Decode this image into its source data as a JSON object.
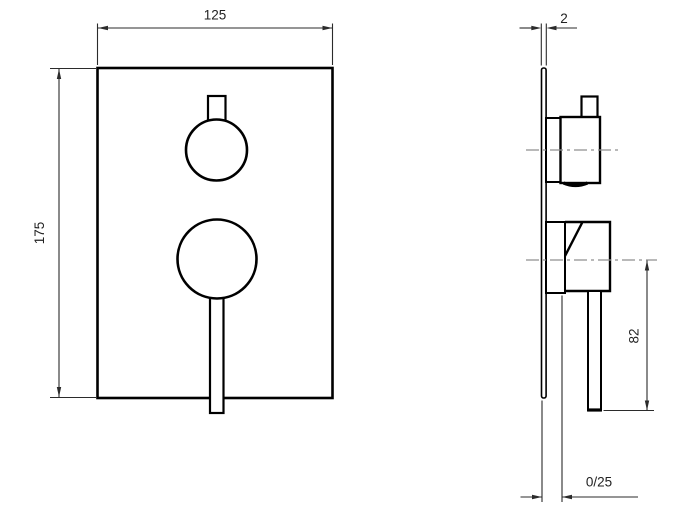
{
  "drawing": {
    "type": "technical-dimension-drawing",
    "subject": "concealed-shower-mixer-trim",
    "dimensions": {
      "front_width": "125",
      "front_height": "175",
      "plate_thickness": "2",
      "handle_length": "82",
      "depth_adjustment": "0/25"
    },
    "colors": {
      "background": "#ffffff",
      "object_line": "#000000",
      "dimension_line": "#2b2b2b",
      "centerline": "#8f8f8f",
      "text": "#222222"
    }
  }
}
